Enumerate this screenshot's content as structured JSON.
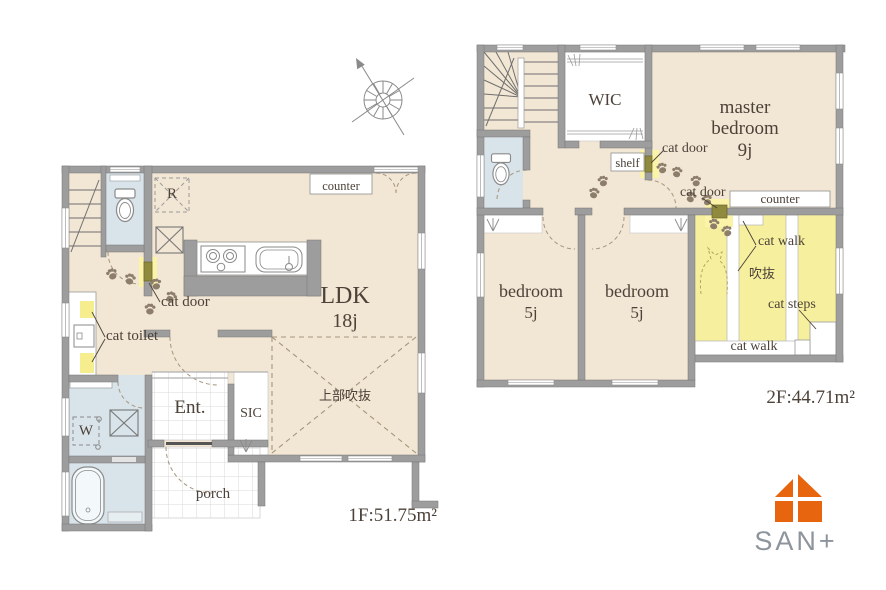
{
  "floor1": {
    "area_label": "1F:51.75m²",
    "ldk": {
      "name": "LDK",
      "size": "18j"
    },
    "entrance": "Ent.",
    "sic": "SIC",
    "porch": "porch",
    "void_label": "上部吹抜",
    "counter": "counter",
    "fridge": "R",
    "washer": "W",
    "cat_door": "cat door",
    "cat_toilet": "cat toilet"
  },
  "floor2": {
    "area_label": "2F:44.71m²",
    "wic": "WIC",
    "master": {
      "name": "master bedroom",
      "size": "9j"
    },
    "bedroom1": {
      "name": "bedroom",
      "size": "5j"
    },
    "bedroom2": {
      "name": "bedroom",
      "size": "5j"
    },
    "shelf": "shelf",
    "counter": "counter",
    "void_label": "吹抜",
    "cat_door": "cat door",
    "cat_walk": "cat walk",
    "cat_steps": "cat steps"
  },
  "logo": {
    "text": "SAN+",
    "brand_color": "#e8650f",
    "text_color": "#8d949c"
  },
  "palette": {
    "floor_beige": "#f2e6d4",
    "wet_blue": "#d8e4ea",
    "void_yellow": "#f6f09e",
    "wall_gray": "#9d9d9d",
    "cat_door_olive": "#8f8a3e",
    "cat_door_glow": "#faf3a8",
    "label_text": "#4c4239"
  }
}
